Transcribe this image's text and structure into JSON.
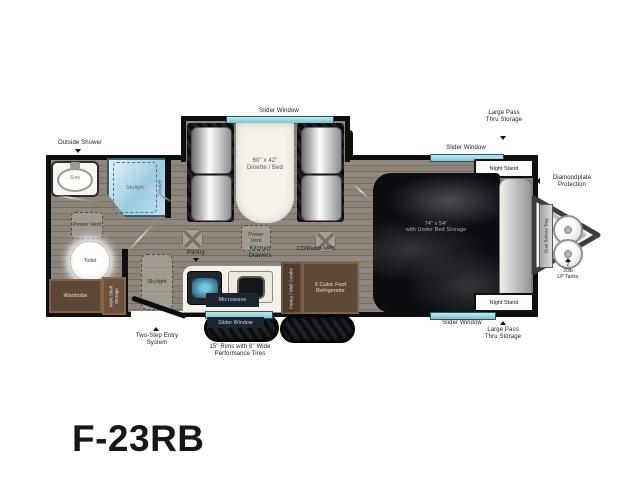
{
  "model": "F-23RB",
  "windows": {
    "dinette": "Slider Window",
    "kitchen": "Slider Window",
    "bedroom_top": "Slider Window",
    "bedroom_bottom": "Slider Window"
  },
  "bathroom": {
    "outside_shower": "Outside Shower",
    "sink": "Sink",
    "shower": "Shower",
    "skylight": "Skylight",
    "power_vent": "Power Vent",
    "toilet": "Toilet",
    "wardrobe": "Wardrobe",
    "multi_shelf": "Multi Shelf Storage"
  },
  "galley": {
    "skylight": "Skylight",
    "entry": "Two-Step Entry System",
    "pantry": "Pantry",
    "power_vent": "Power Vent",
    "kitchen_drawers": "Kitchen Drawers",
    "cd_radio": "CD/Radio-MP3",
    "microwave": "Microwave",
    "pantry_wall_combo": "Pantry / Wall Combo",
    "refrigerator": "5 Cubic Foot Refrigerator"
  },
  "dinette": {
    "size": "60\" x 42\"",
    "label": "Dinette / Bed"
  },
  "bedroom": {
    "bed_size": "74\" x 54\"",
    "bed_label": "with Under Bed Storage",
    "night_stand": "Night Stand",
    "pass_thru": "Large Pass Thru Storage"
  },
  "exterior": {
    "tires": "15\" Rims with 8\" Wide Performance Tires",
    "diamondplate": "Diamondplate Protection",
    "battery_tray": "Dual Battery Tray",
    "lp_count": "2",
    "lp_size": "20lb",
    "lp_label": "LP Tanks"
  },
  "colors": {
    "window_teal": "#8ed0da",
    "wall": "#0e0e0e",
    "floor": "#8a8178",
    "cabinet_brown": "#5d4837",
    "dark_label_bg": "#1c2430"
  }
}
